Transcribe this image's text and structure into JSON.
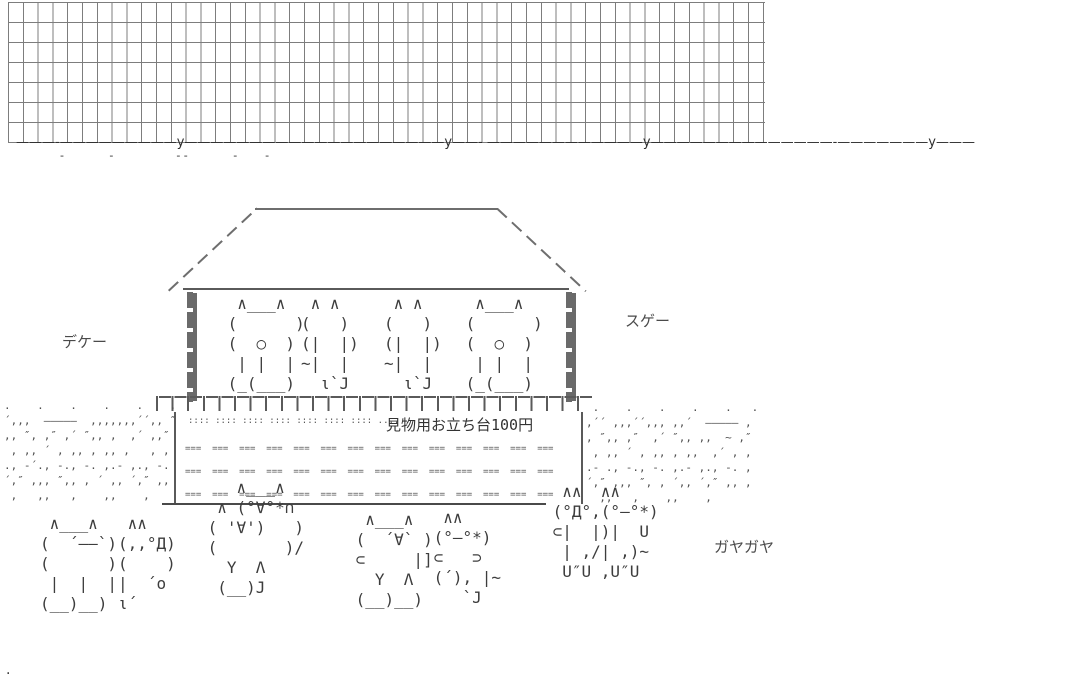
{
  "scene": {
    "bg": "#ffffff",
    "wall_line_color": "#7d7d7d",
    "art_ink_color": "#3d3d3d",
    "label_ink_color": "#4a4a4a"
  },
  "labels": {
    "dekee": "デケー",
    "sugee": "スゲー",
    "gayagaya": "ガヤガヤ",
    "platform_sign": "見物用お立ち台100円",
    "corner_dot": "."
  },
  "wall": {
    "rows": 7,
    "cols": 51
  },
  "ground": {
    "horizon_line": "———‐—————————y————————————————————y——‐ ————————————y——————————————‐———————y———",
    "horizon_ticks": "‐             ‐                  ‐ ‐             ‐        ‐",
    "left_texture": [
      ".    .    .    .    .    .",
      "´‚‚‚  —————  ‚‚‚‚‚‚‚´´‚‚ ″",
      "‚, ″‚ ,″ ‚´ ″‚, ,  ,´ ‚,″",
      " , ,‚ ´ , ‚‚ , ,, ,   ‚ ,",
      "., ‐´., ‐., ‐. ,.‐ ,., ‐.",
      "´‚″ ‚,‚ ″‚, ‚ ´ ‚, ´‚″ ‚,",
      " ‚   ,,   ,    ,,    ,"
    ],
    "right_texture": [
      " .    .    .    .    .   .",
      "‚´´ ‚‚‚´´‚‚‚ ‚‚´  ————— ‚",
      "‚ ″‚, ,″  ‚´ ″‚, ,‚  ~ ‚″",
      " , ‚, ´ , ‚‚ , ,,  ,´ ‚ ,",
      ".‐ ., ‐., ‐. ,.‐ ,., ‐. ,",
      "´‚″ ‚,‚ ″‚ ‚ ´‚, ´‚″ ‚, ‚",
      "  ,,   ‚    ,,    ,"
    ]
  },
  "platform": {
    "dots_row": ":::: :::: :::: :::: :::: :::: :::: ....",
    "mesh_rows": [
      "===  ===  ===  ===  ===  ===  ===  ===  ===  ===  ===  ===  ===  ===",
      "===  ===  ===  ===  ===  ===  ===  ===  ===  ===  ===  ===  ===  ===",
      "===  ===  ===  ===  ===  ===  ===  ===  ===  ===  ===  ===  ===  ==="
    ]
  },
  "stage_cats": {
    "back_round_1": [
      "  ∧___∧",
      " (      )",
      " (  ○  )",
      "  | |  |",
      " (_(___)"
    ],
    "back_tail_1": [
      " ∧ ∧",
      "(   )",
      "(|  |)",
      "~|  |",
      "  ι`J"
    ],
    "back_tail_2": [
      " ∧ ∧",
      "(   )",
      "(|  |)",
      "~|  |",
      "  ι`J"
    ],
    "back_round_2": [
      "  ∧___∧",
      " (      )",
      " (  ○  )",
      "  | |  |",
      " (_(___)"
    ]
  },
  "crowd_cats": {
    "calm": [
      " ∧___∧",
      "(  ´——`)",
      "(      )",
      " |  |  |",
      "(__)__)"
    ],
    "shii": [
      " ∧∧",
      "(,,°Д)",
      "(    )",
      "|  ´o",
      "ι´"
    ],
    "cheer_pair": [
      "    ∧___∧",
      "  ∧ (°∀°*∩",
      " ( '∀')   )",
      " (       )/",
      "   Y  Λ",
      "  (__)J"
    ],
    "camera": [
      "  ∧___∧",
      " (  ´∀` )",
      " ⊂     |]",
      "   Y  Λ",
      " (__)__)"
    ],
    "walker": [
      "  ∧∧",
      " (°—°*)",
      " ⊂   ⊃",
      " (´), |~",
      "    `J"
    ],
    "watch_pair": [
      "  ∧∧  ∧∧",
      " (°Д°,(°—°*)",
      " ⊂|  |)|  U",
      "  | ,/| ,)~",
      "  U″U ,U″U"
    ]
  }
}
